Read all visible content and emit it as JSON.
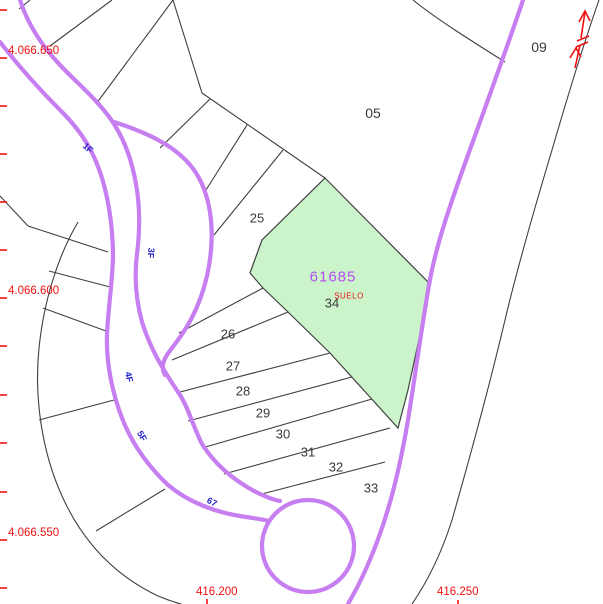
{
  "highlight": {
    "id": "61685",
    "land_use": "SUELO",
    "number": "34"
  },
  "parcels": {
    "n05": "05",
    "n09": "09",
    "n25": "25",
    "n26": "26",
    "n27": "27",
    "n28": "28",
    "n29": "29",
    "n30": "30",
    "n31": "31",
    "n32": "32",
    "n33": "33"
  },
  "road_labels": {
    "s1": "1F",
    "s3": "3F",
    "s4": "4F",
    "s5": "5F",
    "s67": "67"
  },
  "grid": {
    "y_labels": [
      "4.066.650",
      "4.066.600",
      "4.066.550"
    ],
    "x_labels": [
      "416.200",
      "416.250"
    ]
  },
  "colors": {
    "road": "#c77ef0",
    "parcel-fill": "#cbf4cb",
    "parcel-id": "#b44df2",
    "grid-red": "#ee1111",
    "road-label-blue": "#2222cc",
    "line": "#3f3f3f",
    "label": "#3a3a3a"
  }
}
